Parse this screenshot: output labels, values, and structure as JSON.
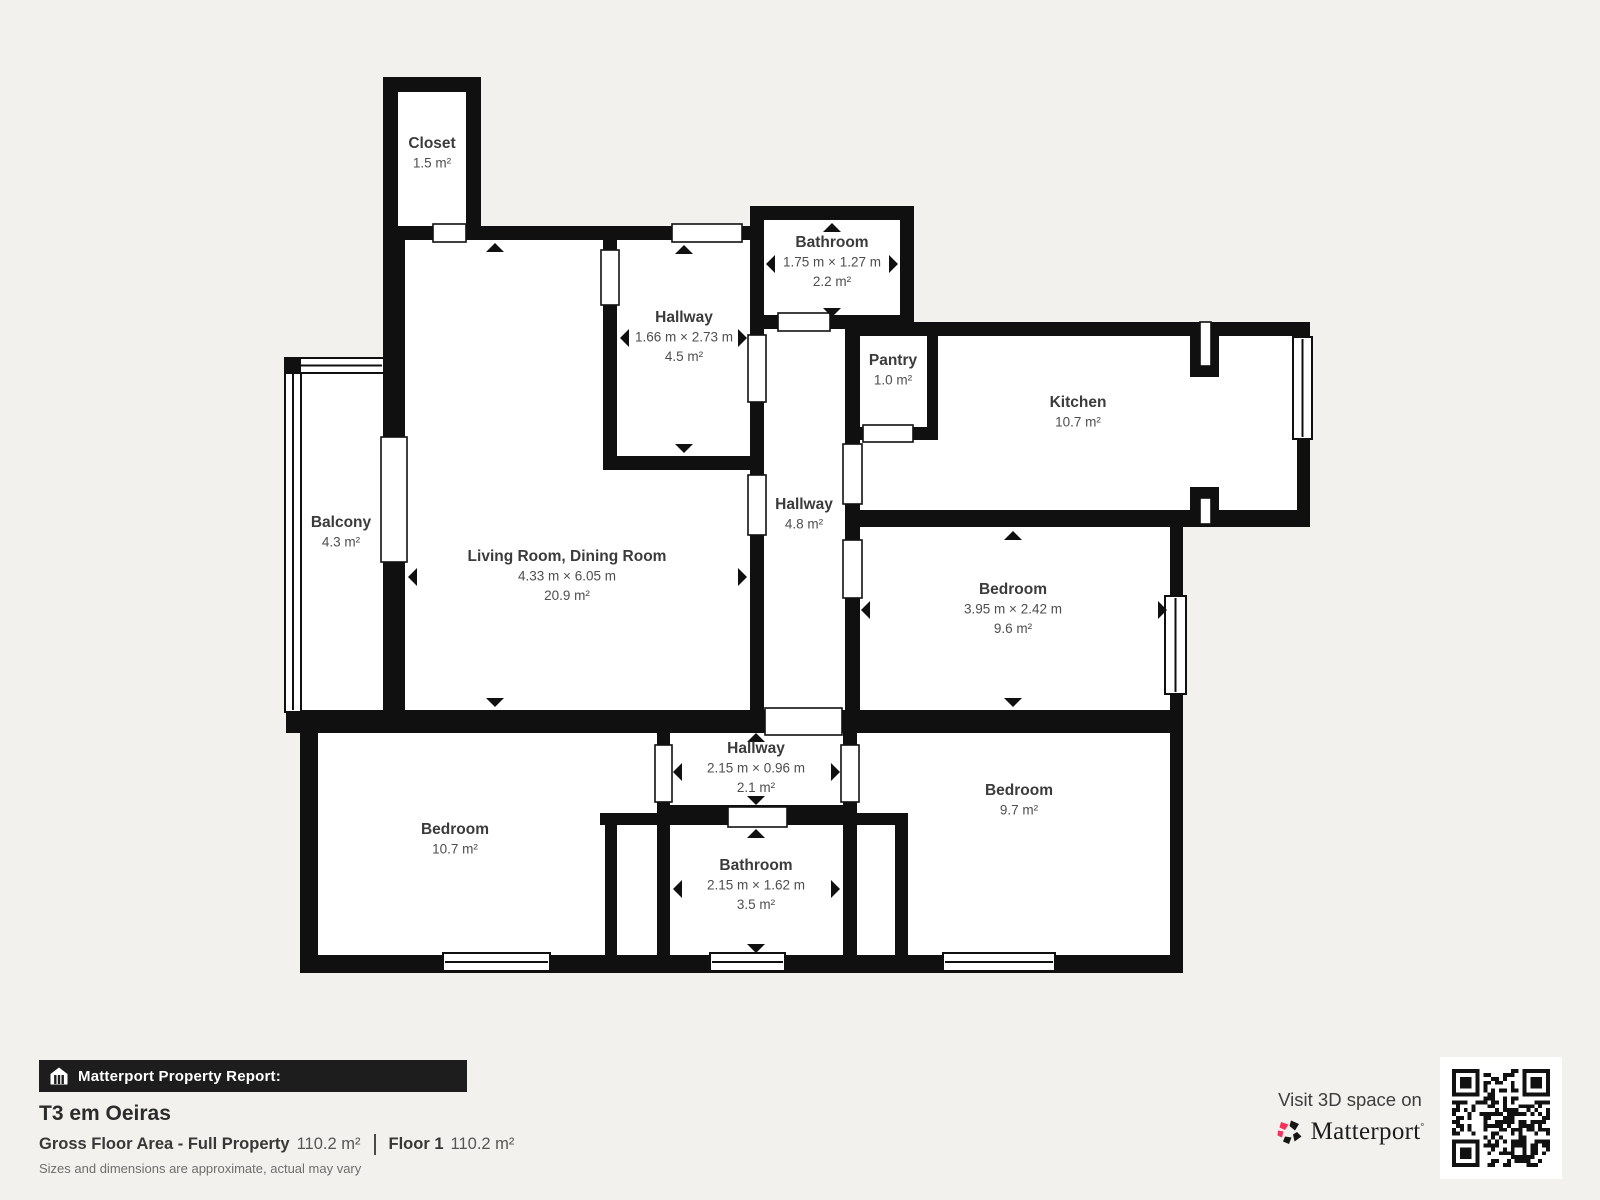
{
  "colors": {
    "background": "#f2f1ee",
    "wall": "#101010",
    "room_fill": "#ffffff",
    "room_label": "#3b3b3b",
    "room_sub_label": "#4e4e4e",
    "bar_background": "#1d1d1d",
    "accent_pink": "#f5325b"
  },
  "floorplan": {
    "rooms": [
      {
        "id": "closet",
        "name": "Closet",
        "area": "1.5 m²",
        "label_x": 432,
        "label_y": 148
      },
      {
        "id": "bathroom-top",
        "name": "Bathroom",
        "dims": "1.75 m × 1.27 m",
        "area": "2.2 m²",
        "label_x": 832,
        "label_y": 247,
        "arrows": {
          "up": [
            832,
            228
          ],
          "down": [
            832,
            312
          ],
          "left": [
            771,
            264
          ],
          "right": [
            893,
            264
          ]
        }
      },
      {
        "id": "hallway-upper",
        "name": "Hallway",
        "dims": "1.66 m × 2.73 m",
        "area": "4.5 m²",
        "label_x": 684,
        "label_y": 322,
        "arrows": {
          "up": [
            684,
            250
          ],
          "down": [
            684,
            448
          ],
          "left": [
            625,
            338
          ],
          "right": [
            742,
            338
          ]
        }
      },
      {
        "id": "pantry",
        "name": "Pantry",
        "area": "1.0 m²",
        "label_x": 893,
        "label_y": 365
      },
      {
        "id": "kitchen",
        "name": "Kitchen",
        "area": "10.7 m²",
        "label_x": 1078,
        "label_y": 407
      },
      {
        "id": "balcony",
        "name": "Balcony",
        "area": "4.3 m²",
        "label_x": 341,
        "label_y": 527
      },
      {
        "id": "living-dining",
        "name": "Living Room, Dining Room",
        "dims": "4.33 m × 6.05 m",
        "area": "20.9 m²",
        "label_x": 567,
        "label_y": 561,
        "arrows": {
          "up": [
            495,
            248
          ],
          "down": [
            495,
            702
          ],
          "left": [
            413,
            577
          ],
          "right": [
            742,
            577
          ]
        }
      },
      {
        "id": "hallway-middle",
        "name": "Hallway",
        "area": "4.8 m²",
        "label_x": 804,
        "label_y": 509
      },
      {
        "id": "bedroom-right",
        "name": "Bedroom",
        "dims": "3.95 m × 2.42 m",
        "area": "9.6 m²",
        "label_x": 1013,
        "label_y": 594,
        "arrows": {
          "up": [
            1013,
            536
          ],
          "down": [
            1013,
            702
          ],
          "left": [
            866,
            610
          ],
          "right": [
            1162,
            610
          ]
        }
      },
      {
        "id": "hallway-bottom",
        "name": "Hallway",
        "dims": "2.15 m × 0.96 m",
        "area": "2.1 m²",
        "label_x": 756,
        "label_y": 753,
        "arrows": {
          "up": [
            756,
            738
          ],
          "down": [
            756,
            800
          ],
          "left": [
            678,
            772
          ],
          "right": [
            835,
            772
          ]
        }
      },
      {
        "id": "bedroom-bottom-left",
        "name": "Bedroom",
        "area": "10.7 m²",
        "label_x": 455,
        "label_y": 834
      },
      {
        "id": "bathroom-bottom",
        "name": "Bathroom",
        "dims": "2.15 m × 1.62 m",
        "area": "3.5 m²",
        "label_x": 756,
        "label_y": 870,
        "arrows": {
          "up": [
            756,
            834
          ],
          "down": [
            756,
            948
          ],
          "left": [
            678,
            889
          ],
          "right": [
            835,
            889
          ]
        }
      },
      {
        "id": "bedroom-bottom-right",
        "name": "Bedroom",
        "area": "9.7 m²",
        "label_x": 1019,
        "label_y": 795
      }
    ]
  },
  "footer": {
    "report_label": "Matterport Property Report:",
    "title": "T3 em Oeiras",
    "gross_floor_area_label": "Gross Floor Area - Full Property",
    "gross_floor_area_value": "110.2 m²",
    "floor_label": "Floor 1",
    "floor_value": "110.2 m²",
    "disclaimer": "Sizes and dimensions are approximate, actual may vary",
    "visit_text": "Visit 3D space on",
    "brand": "Matterport"
  }
}
